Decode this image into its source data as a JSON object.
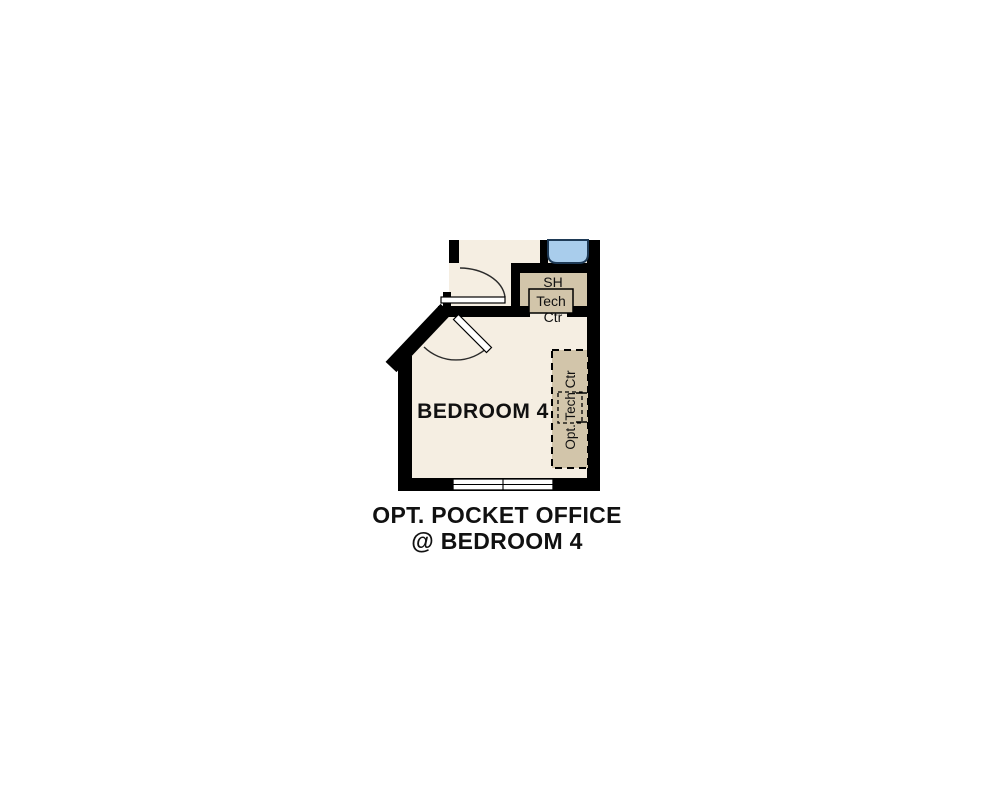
{
  "page": {
    "background": "#ffffff"
  },
  "plan": {
    "room_label": "BEDROOM 4",
    "shelf_label": "SH",
    "tech_center_label_line1": "Tech",
    "tech_center_label_line2": "Ctr",
    "opt_tech_center_label": "Opt. Tech Ctr",
    "caption_line1": "OPT. POCKET OFFICE",
    "caption_line2": "@ BEDROOM 4",
    "colors": {
      "floor": "#f5eee2",
      "cabinet": "#d2c5aa",
      "wall": "#000000",
      "sink_fill": "#a9cdec",
      "sink_stroke": "#1e3a56",
      "line": "#2b2b2b",
      "text": "#111111"
    }
  }
}
